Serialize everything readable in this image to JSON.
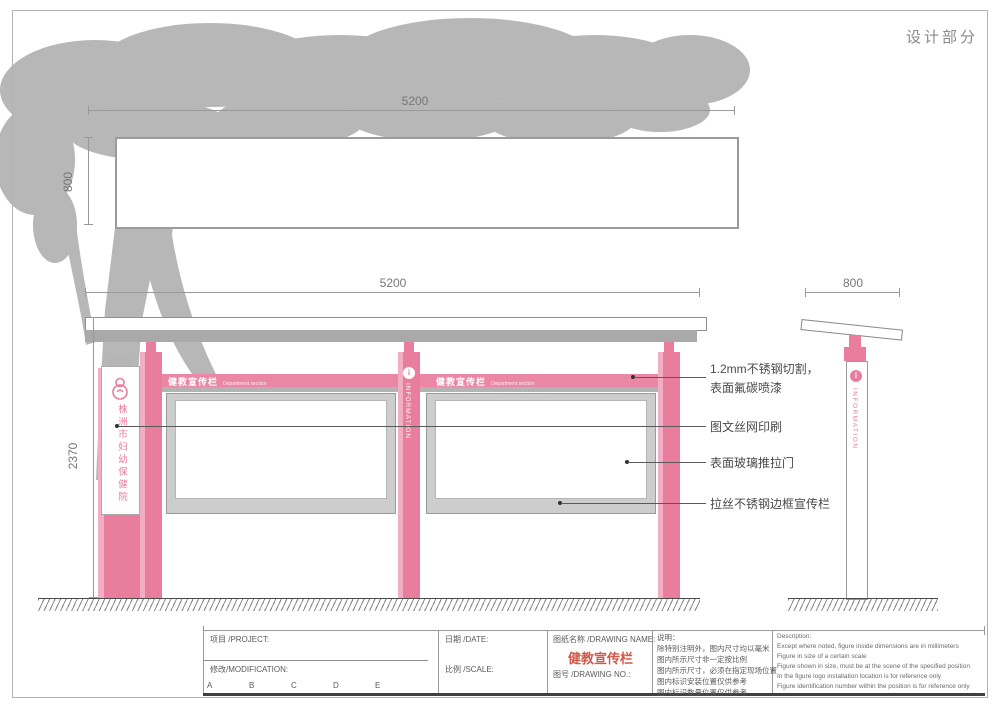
{
  "page": {
    "section_title": "设计部分"
  },
  "colors": {
    "pink": "#e87d9e",
    "pink_light": "#f2aec4",
    "structure_gray": "#a9a9a9",
    "tree_gray": "#b7b7b7",
    "drawing_name_red": "#cf5a4a"
  },
  "dimensions": {
    "banner_width": "5200",
    "banner_height": "800",
    "front_width": "5200",
    "front_height": "2370",
    "side_width": "800"
  },
  "front_view": {
    "board_headers": [
      {
        "title": "健教宣传栏",
        "subtitle": "Department section"
      },
      {
        "title": "健教宣传栏",
        "subtitle": "Department section"
      }
    ],
    "info_column": {
      "letter": "i",
      "label": "INFORMATION"
    },
    "hospital_sign": {
      "name": "株洲市妇幼保健院"
    }
  },
  "side_view": {
    "letter": "i",
    "label": "INFORMATION"
  },
  "callouts": {
    "steel_cut": {
      "line1": "1.2mm不锈钢切割，",
      "line2": "表面氟碳喷漆"
    },
    "silk_print": {
      "text": "图文丝网印刷"
    },
    "glass_door": {
      "text": "表面玻璃推拉门"
    },
    "steel_frame": {
      "text": "拉丝不锈钢边框宣传栏"
    }
  },
  "title_block": {
    "project_label": "项目 /PROJECT:",
    "modification_label": "修改/MODIFICATION:",
    "revision_letters": [
      "A",
      "B",
      "C",
      "D",
      "E"
    ],
    "date_label": "日期 /DATE:",
    "scale_label": "比例 /SCALE:",
    "drawing_name_label": "图纸名称 /DRAWING NAME:",
    "drawing_name": "健教宣传栏",
    "drawing_no_label": "图号 /DRAWING NO.:",
    "notes_cn": [
      "说明：",
      "除特别注明外，图内尺寸均以毫米",
      "图内所示尺寸非一定按比例",
      "图内所示尺寸，必须在指定现场位置",
      "图内标识安装位置仅供参考",
      "图内标识数量位置仅供参考"
    ],
    "notes_en": [
      "Description:",
      "Except where noted, figure inside dimensions are in millimeters",
      "Figure in size of a certain scale",
      "Figure shown in size, must be at the scene of the specified position",
      "In the figure logo installation location is for reference only",
      "Figure identification number within the position is for reference only"
    ]
  }
}
